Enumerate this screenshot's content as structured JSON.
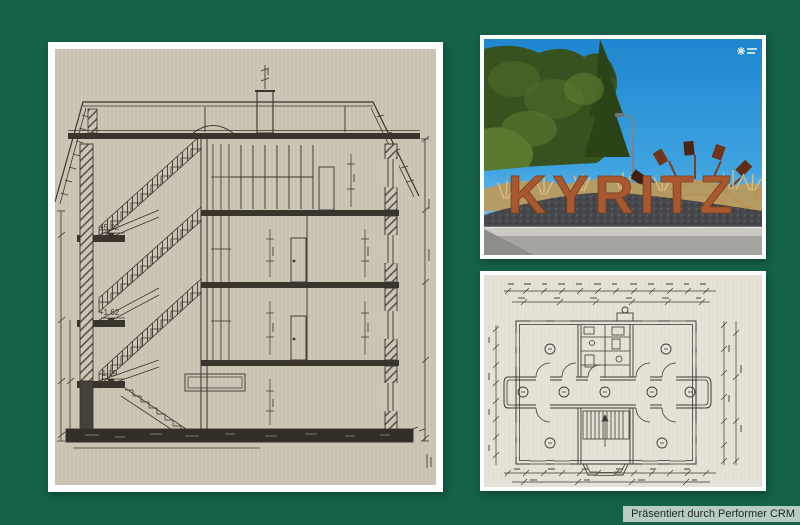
{
  "page": {
    "background_color": "#15614a",
    "caption": "Präsentiert durch Performer CRM",
    "caption_bg": "#b7cdc2"
  },
  "panels": {
    "cross_section": {
      "description": "hand-drawn building cross-section with staircase",
      "paper_color": "#cdc6b7",
      "ink_color": "#3a352c",
      "elevations": [
        "+5.02",
        "+1.62",
        "-1.19"
      ]
    },
    "town_sign_photo": {
      "sign_text": "KYRITZ",
      "letter_color": "#a8582e",
      "sky_color": "#2793d8",
      "sculpture_color": "#8a4a28"
    },
    "floor_plan": {
      "description": "hand-drawn symmetric floor plan with central staircase",
      "paper_color": "#e7e2d7",
      "ink_color": "#3f3a31"
    }
  }
}
